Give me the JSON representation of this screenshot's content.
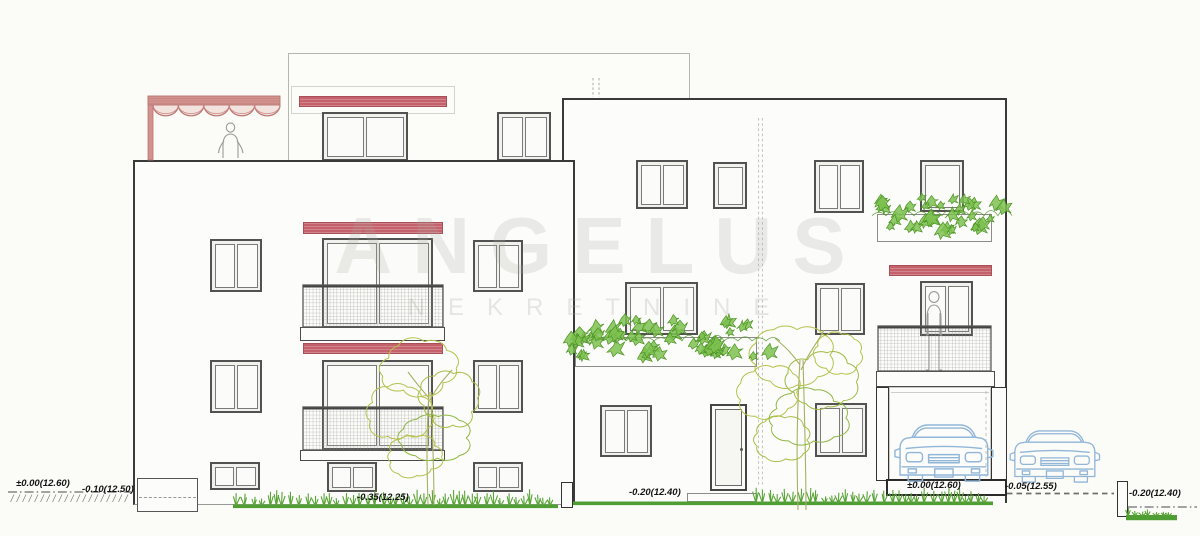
{
  "watermark": {
    "primary": "ANGELUS",
    "secondary": "NEKRETNINE"
  },
  "elevation_labels": {
    "far_left_zero": "±0.00(12.60)",
    "far_left_minus_010": "-0.10(12.50)",
    "left_building_base": "-0.35(12.25)",
    "right_building_base": "-0.20(12.40)",
    "garage_floor": "±0.00(12.60)",
    "driveway": "-0.05(12.55)",
    "far_right_low": "-0.20(12.40)"
  },
  "colors": {
    "awning_red": "#c4616b",
    "pergola_pink": "#d2928e",
    "grass_green": "#4f9e33",
    "foliage_green": "#7cc14f",
    "tree_outline": "#b5c24c",
    "car_blue": "#92b6d8",
    "line_dark": "#3a3a3a",
    "watermark_gray": "#a8a8a0"
  }
}
